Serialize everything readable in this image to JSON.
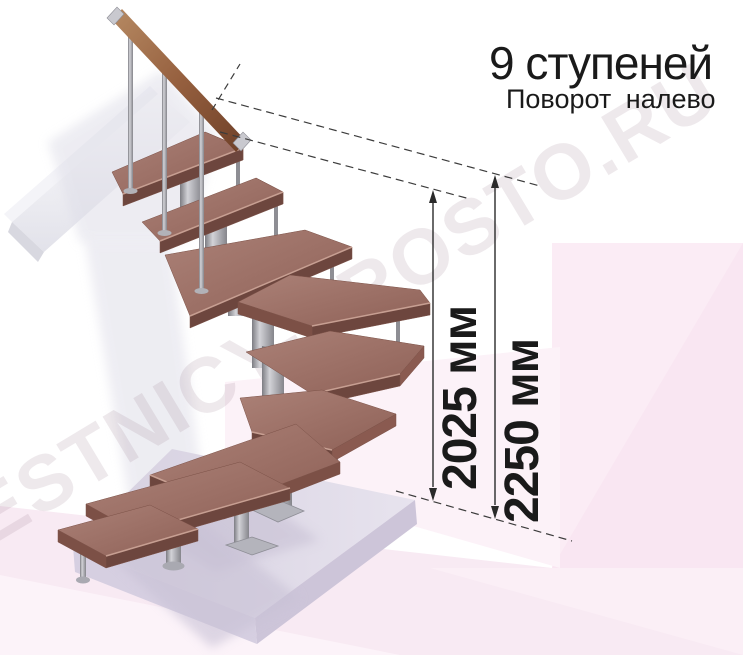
{
  "title": {
    "heading": "9 ступеней",
    "subheading": "Поворот налево"
  },
  "dimensions": {
    "stair_height": {
      "label": "2025 мм"
    },
    "total_height": {
      "label": "2250 мм"
    }
  },
  "watermark": {
    "text": "LESTNICY-PROSTO.RU"
  },
  "stair": {
    "steps_total": 9,
    "turn_direction": "налево"
  },
  "colors": {
    "tread_top": "#a1766b",
    "tread_front": "#6d463e",
    "tread_side": "#8a5a50",
    "handrail_wood": "#9c6b4e",
    "metal": "#9b9ba1",
    "floor_slab_top": "#dcd6e3",
    "floor_slab_front": "#cdc5d9",
    "backdrop_pink": "#fbecf5",
    "dimension_line": "#2a2a2a",
    "text": "#1a1a1a"
  }
}
